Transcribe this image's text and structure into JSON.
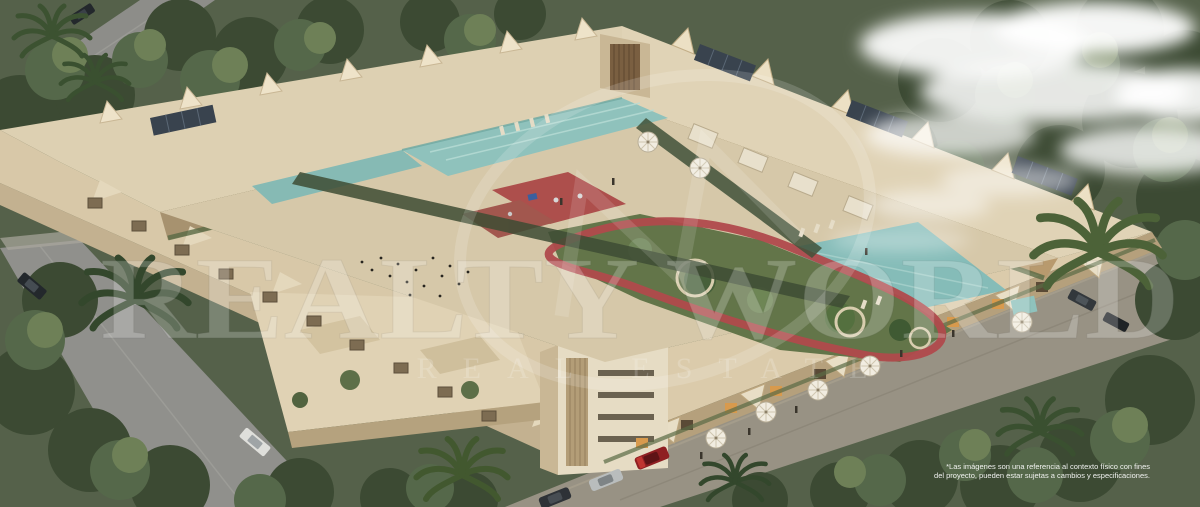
{
  "scene": {
    "type": "aerial architectural render",
    "subject": "Beige low-rise apartment complex built around a central courtyard with swimming pools, gardens, red jogging track and playground, surrounded by dense trees, palm trees, roads with cars and clouds at top right",
    "colors": {
      "building_roof": "#ddd0b2",
      "building_facade_shadow": "#b09a76",
      "solar_panel": "#39434e",
      "pool_water": "#8fc2bc",
      "garden_green": "#637549",
      "jogging_track_red": "#b04a4c",
      "playground_red": "#ad4f4c",
      "trees_dark": "#3c4a33",
      "trees_light": "#6e8057",
      "road_gray": "#90908c",
      "cloud_white": "#ffffff",
      "car_red": "#8f1f22",
      "watermark_white": "#ffffff"
    }
  },
  "watermark": {
    "logo": "realty-world-circle-monogram",
    "title": "REALTY WORLD",
    "subtitle": "REAL ESTATE"
  },
  "disclaimer": {
    "line1": "*Las imágenes son una referencia al contexto físico con fines",
    "line2": "del proyecto, pueden estar sujetas a cambios y especificaciones."
  }
}
